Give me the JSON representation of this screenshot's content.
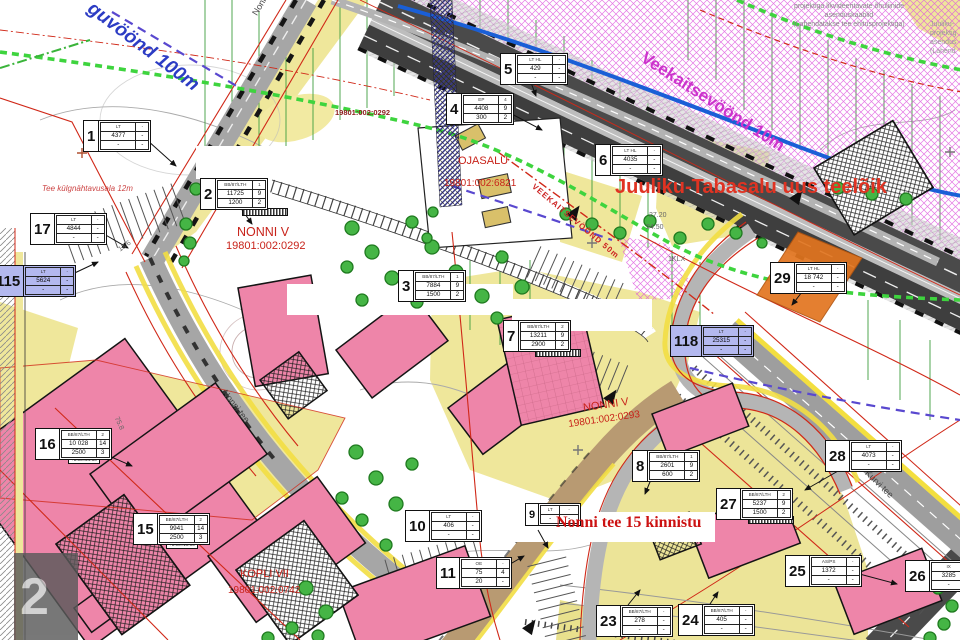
{
  "texts": {
    "juuliku_title": "Juuliku-Tabasalu uus teelõik",
    "nonni15_note": "Nonni tee 15 kinnistu",
    "veekaitse10": "Veekaitsevöönd 10m",
    "veekaitse50": "VEEKAITSEVÖÖND 50m",
    "guvoond": "guvöönd 100m",
    "tee_kulg": "Tee külgnähtavusala 12m",
    "watermark": "2"
  },
  "notes": {
    "line1": "projektiga likvideeritavate õhuliinide",
    "line2": "asenduskaablid",
    "line3": "(Lahendatakse tee ehitusprojektiga)",
    "edge1": "Juuliku-",
    "edge2": "projektig",
    "edge3": "asendus",
    "edge4": "(Lahend"
  },
  "cadastral": {
    "nonni_v1_name": "NONNI V",
    "nonni_v1_code": "19801:002:0292",
    "nonni_v2_name": "NONNI V",
    "nonni_v2_code": "19801:002:0293",
    "ojasalu_name": "OJASALU",
    "ojasalu_code": "19801:002:6821",
    "kopli_name": "KOPLI VII",
    "kopli_code": "19801:002:0742",
    "code_top": "19801:002:0292"
  },
  "roads": {
    "nonni_top": "Nonni tee",
    "nonni_mid": "Nonni tee",
    "kurvi": "Kurvi tee"
  },
  "measures": {
    "m1": "13.6",
    "m2": "75.8",
    "m3": "27.20",
    "m4": "24.50",
    "m5": "1KLX"
  },
  "colors": {
    "note_red": "#d42b14",
    "magenta": "#cc33cc",
    "boundary_blue": "#2c3cc4",
    "parcel_purple": "#b3b8ef",
    "junction_orange": "#e2751f"
  },
  "parcels": {
    "p1": {
      "num": "1",
      "rows": [
        [
          "LT",
          "-"
        ],
        [
          "4377",
          "-"
        ],
        [
          "-",
          "-"
        ]
      ]
    },
    "p2": {
      "num": "2",
      "rows": [
        [
          "BB/87/LTH",
          "1"
        ],
        [
          "11725",
          "9"
        ],
        [
          "1200",
          "2"
        ]
      ]
    },
    "p3": {
      "num": "3",
      "rows": [
        [
          "BB/87/LTH",
          "1"
        ],
        [
          "7884",
          "9"
        ],
        [
          "1500",
          "2"
        ]
      ]
    },
    "p4": {
      "num": "4",
      "rows": [
        [
          "EP",
          "4"
        ],
        [
          "4408",
          "9"
        ],
        [
          "300",
          "2"
        ]
      ]
    },
    "p5": {
      "num": "5",
      "rows": [
        [
          "LT  HL",
          "-"
        ],
        [
          "429",
          "-"
        ],
        [
          "-",
          "-"
        ]
      ]
    },
    "p6": {
      "num": "6",
      "rows": [
        [
          "LT  HL",
          "-"
        ],
        [
          "4035",
          "-"
        ],
        [
          "-",
          "-"
        ]
      ]
    },
    "p7": {
      "num": "7",
      "rows": [
        [
          "BB/87/LTH",
          "2"
        ],
        [
          "13211",
          "9"
        ],
        [
          "2900",
          "2"
        ]
      ]
    },
    "p8": {
      "num": "8",
      "rows": [
        [
          "BB/87/LTH",
          "1"
        ],
        [
          "2601",
          "9"
        ],
        [
          "600",
          "2"
        ]
      ]
    },
    "p9": {
      "num": "9",
      "rows": [
        [
          "LT",
          "-"
        ],
        [
          "-",
          "-"
        ]
      ]
    },
    "p10": {
      "num": "10",
      "rows": [
        [
          "LT",
          "-"
        ],
        [
          "406",
          "-"
        ],
        [
          "-",
          "-"
        ]
      ]
    },
    "p11": {
      "num": "11",
      "rows": [
        [
          "OE",
          "-"
        ],
        [
          "75",
          "4"
        ],
        [
          "20",
          "-"
        ]
      ]
    },
    "p15": {
      "num": "15",
      "rows": [
        [
          "BB/87/LTH",
          "2"
        ],
        [
          "9941",
          "14"
        ],
        [
          "2500",
          "3"
        ]
      ],
      "chip": "+1.00=18.90"
    },
    "p16": {
      "num": "16",
      "rows": [
        [
          "BB/87/LTH",
          "2"
        ],
        [
          "10 028",
          "14"
        ],
        [
          "2500",
          "3"
        ]
      ],
      "chip": "+1.00=24.80"
    },
    "p17": {
      "num": "17",
      "rows": [
        [
          "LT",
          "-"
        ],
        [
          "4844",
          "-"
        ],
        [
          "-",
          "-"
        ]
      ]
    },
    "p23": {
      "num": "23",
      "rows": [
        [
          "BB/87/LTH",
          "-"
        ],
        [
          "278",
          "-"
        ],
        [
          "-",
          "-"
        ]
      ]
    },
    "p24": {
      "num": "24",
      "rows": [
        [
          "BB/87/LTH",
          "-"
        ],
        [
          "405",
          "-"
        ],
        [
          "-",
          "-"
        ]
      ]
    },
    "p25": {
      "num": "25",
      "rows": [
        [
          "AS/PS",
          "-"
        ],
        [
          "1372",
          "-"
        ],
        [
          "-",
          "-"
        ]
      ]
    },
    "p26": {
      "num": "26",
      "rows": [
        [
          "IX",
          "-"
        ],
        [
          "3285",
          "-"
        ],
        [
          "-",
          "-"
        ]
      ]
    },
    "p27": {
      "num": "27",
      "rows": [
        [
          "BB/87/LTH",
          "2"
        ],
        [
          "5237",
          "9"
        ],
        [
          "1500",
          "2"
        ]
      ]
    },
    "p28": {
      "num": "28",
      "rows": [
        [
          "LT",
          "-"
        ],
        [
          "4073",
          "-"
        ],
        [
          "-",
          "-"
        ]
      ]
    },
    "p29": {
      "num": "29",
      "rows": [
        [
          "LT  HL",
          "-"
        ],
        [
          "18 742",
          "-"
        ],
        [
          "-",
          "-"
        ]
      ]
    },
    "p115": {
      "num": "115",
      "rows": [
        [
          "LT",
          "-"
        ],
        [
          "5624",
          "-"
        ],
        [
          "-",
          "-"
        ]
      ]
    },
    "p118": {
      "num": "118",
      "rows": [
        [
          "LT",
          "-"
        ],
        [
          "25315",
          "-"
        ],
        [
          "-",
          "-"
        ]
      ]
    }
  }
}
